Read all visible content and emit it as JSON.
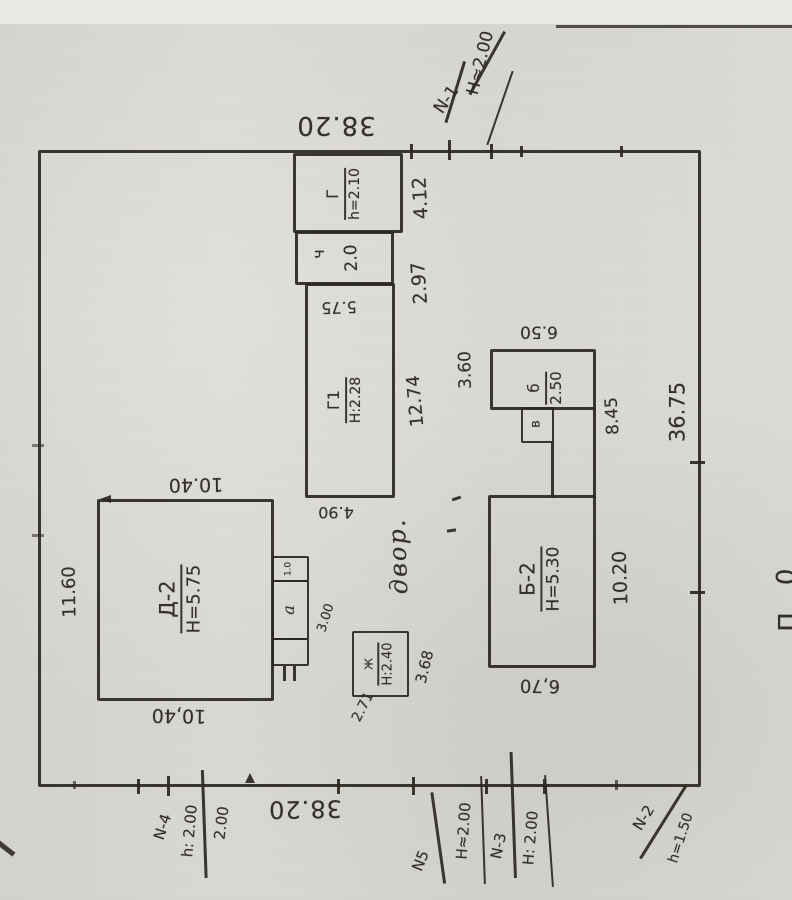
{
  "scan": {
    "boundary_top": "38.20",
    "boundary_bottom": "38.20",
    "boundary_right": "36.75",
    "courtyard": "двор.",
    "edge_fragment_top": "0",
    "edge_fragment_bottom": "П"
  },
  "d2": {
    "label": "Д-2",
    "height": "H=5.75",
    "dim_top": "10.40",
    "dim_bottom": "10,40",
    "dim_left": "11.60"
  },
  "porch": {
    "label": "a",
    "dim": "3.00",
    "dim_small": "1.0"
  },
  "g": {
    "label": "Г",
    "height": "h=2.10",
    "dim_side": "4.12"
  },
  "ch": {
    "label": "ч",
    "dim": "2.0",
    "dim_side": "2.97"
  },
  "g1": {
    "label": "Г1",
    "height": "Н:2.28",
    "dim_top": "5.75",
    "dim_side": "12.74",
    "dim_bottom": "4.90"
  },
  "zh": {
    "label": "Ж",
    "height": "H:2.40",
    "dim_side": "3.68",
    "dim_bottom": "2.71"
  },
  "b": {
    "label": "б",
    "dim": "2.50",
    "dim_top": "6.50",
    "dim_left": "3.60",
    "dim_side": "8.45"
  },
  "v": {
    "label": "в"
  },
  "b2": {
    "label": "Б-2",
    "height": "H=5.30",
    "dim_side": "10.20",
    "dim_bottom": "6,70"
  },
  "markers": {
    "n1": {
      "label": "N-1",
      "value": "H≈2.00"
    },
    "n4": {
      "label": "N-4",
      "value": "h: 2.00",
      "value2": "2.00"
    },
    "n5": {
      "label": "N5",
      "value": "H≈2.00"
    },
    "n3": {
      "label": "N-3",
      "value": "Н: 2.00"
    },
    "n2": {
      "label": "N-2",
      "value": "h=1.50"
    }
  }
}
